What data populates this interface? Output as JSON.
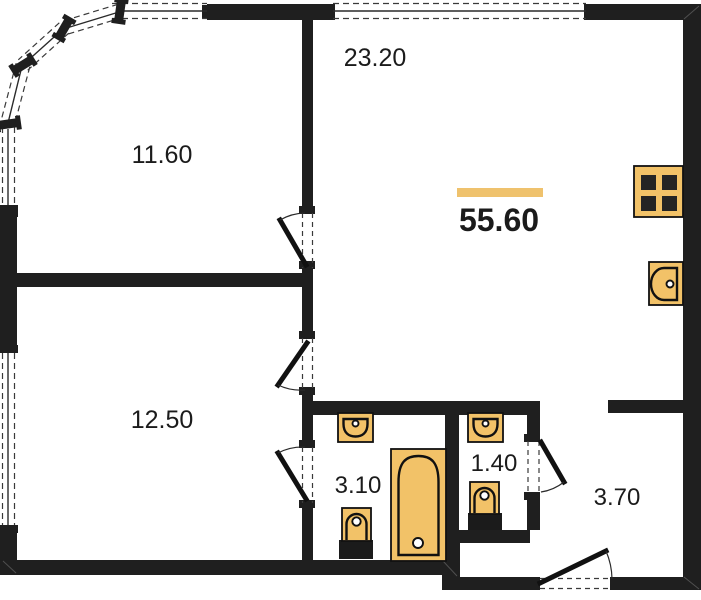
{
  "plan": {
    "type": "apartment-floor-plan",
    "total_area_label": "55.60",
    "rooms": {
      "bedroom_top": {
        "label": "11.60"
      },
      "living_kitchen": {
        "label": "23.20"
      },
      "bedroom_bottom": {
        "label": "12.50"
      },
      "bathroom": {
        "label": "3.10"
      },
      "wc": {
        "label": "1.40"
      },
      "hall": {
        "label": "3.70"
      }
    },
    "fixtures": [
      "stove-icon",
      "kitchen-sink-icon",
      "washbasin-icon",
      "bathtub-icon",
      "toilet-icon"
    ],
    "colors": {
      "wall": "#1f1f1f",
      "fixture_fill": "#F2C268",
      "total_bar": "#EFC26D",
      "line": "#111111",
      "text": "#1b1b1b",
      "background": "#ffffff"
    }
  }
}
